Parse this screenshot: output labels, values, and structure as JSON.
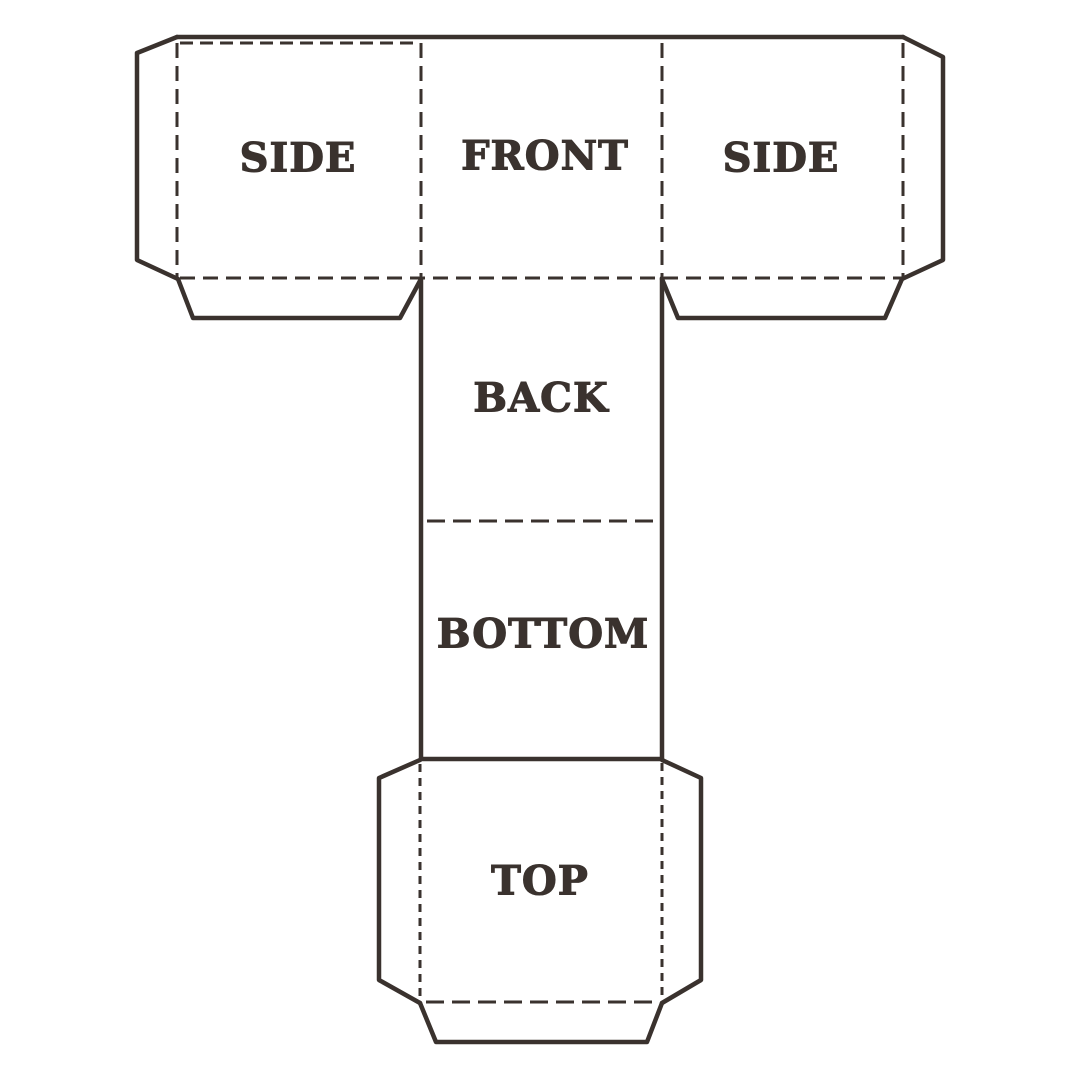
{
  "page": {
    "background_color": "#ffffff",
    "line_color": "#3a322e"
  },
  "drawing": {
    "description": "Cube box papercraft net template with cut lines (solid) and fold lines (dashed)",
    "panels": {
      "side_left": {
        "label": "SIDE"
      },
      "front": {
        "label": "FRONT"
      },
      "side_right": {
        "label": "SIDE"
      },
      "back": {
        "label": "BACK"
      },
      "bottom": {
        "label": "BOTTOM"
      },
      "top": {
        "label": "TOP"
      }
    }
  }
}
